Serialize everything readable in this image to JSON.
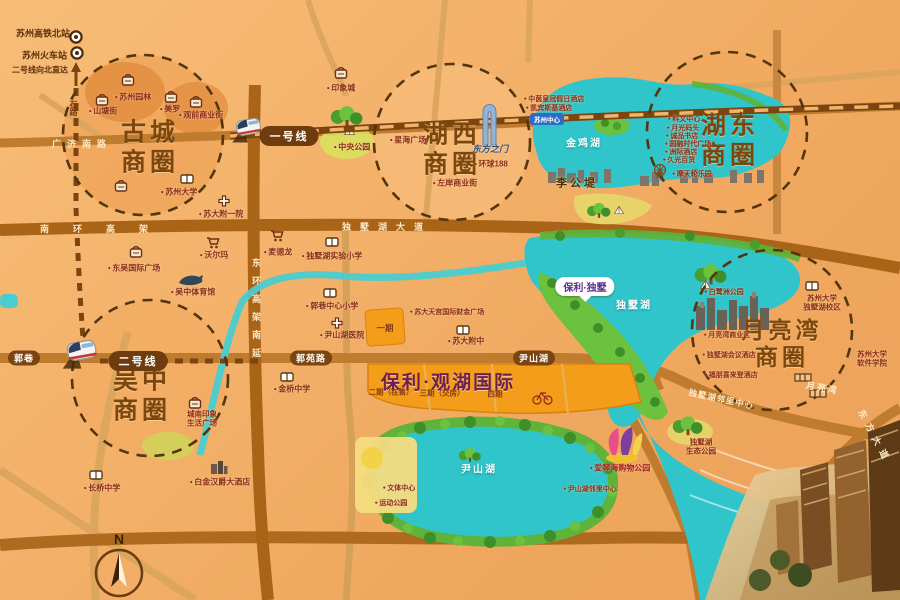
{
  "project": {
    "name": "保利·观湖国际",
    "pin": "保利·独墅",
    "phase1": "一期",
    "phase2": "二期（在售）",
    "phase3": "三期（交房）",
    "phase4": "四期"
  },
  "stations": {
    "north": "苏州高铁北站",
    "main": "苏州火车站",
    "note": "二号线向北直达"
  },
  "metro": {
    "line1": "一号线",
    "line2": "二号线",
    "shilu": "石路"
  },
  "circles": {
    "gucheng": {
      "l1": "古城",
      "l2": "商圈"
    },
    "huxi": {
      "l1": "湖西",
      "l2": "商圈"
    },
    "hudong": {
      "l1": "湖东",
      "l2": "商圈"
    },
    "yueliangwan": {
      "l1": "月亮湾",
      "l2": "商圈"
    },
    "wuzhong": {
      "l1": "吴中",
      "l2": "商圈"
    }
  },
  "lakes": {
    "jinji": "金鸡湖",
    "dushu": "独墅湖",
    "yinshan": "尹山湖",
    "ligongdi": "李公堤"
  },
  "roads": {
    "guangjinanlu": "广济南路",
    "nanhuangaojia": "南环高架",
    "dushuhudadao": "独墅湖大道",
    "donghuannanyan": "东环高架南延",
    "guoxiang": "郭巷",
    "guoyuanlu": "郭苑路",
    "yinshanhu": "尹山湖",
    "yueliangwan": "月亮湾",
    "linlizhongxin": "独墅湖邻里中心",
    "dongfangdadao": "东方大道"
  },
  "compass": "N",
  "pois": [
    {
      "label": "苏州园林"
    },
    {
      "label": "山塘街"
    },
    {
      "label": "美罗"
    },
    {
      "label": "观前商业街"
    },
    {
      "label": "苏州大学"
    },
    {
      "label": "苏大附一院"
    },
    {
      "label": "东吴国际广场"
    },
    {
      "label": "沃尔玛"
    },
    {
      "label": "麦德龙"
    },
    {
      "label": "吴中体育馆"
    },
    {
      "label": "印象城"
    },
    {
      "label": "中央公园"
    },
    {
      "label": "星海广场"
    },
    {
      "label": "东方之门"
    },
    {
      "label": "环球188"
    },
    {
      "label": "左岸商业街"
    },
    {
      "label": "中茵皇冠假日酒店"
    },
    {
      "label": "凯宾斯基酒店"
    },
    {
      "label": "苏州中心"
    },
    {
      "label": "科文中心"
    },
    {
      "label": "月光码头"
    },
    {
      "label": "诚品书店"
    },
    {
      "label": "圆融时代广场"
    },
    {
      "label": "洲际酒店"
    },
    {
      "label": "久光百货"
    },
    {
      "label": "摩天轮乐园"
    },
    {
      "l1": "苏州大学",
      "l2": "独墅湖校区"
    },
    {
      "label": "白鹭洲公园"
    },
    {
      "label": "月亮湾商业区"
    },
    {
      "label": "独墅湖会议酒店"
    },
    {
      "label": "福朋喜来登酒店"
    },
    {
      "l1": "苏州大学",
      "l2": "软件学院"
    },
    {
      "label": "独墅湖实验小学"
    },
    {
      "label": "郭巷中心小学"
    },
    {
      "label": "尹山湖医院"
    },
    {
      "label": "苏大附中"
    },
    {
      "label": "苏大天宫国际财金广场"
    },
    {
      "l1": "城南印象",
      "l2": "生活广场"
    },
    {
      "label": "白金汉爵大酒店"
    },
    {
      "label": "长桥中学"
    },
    {
      "label": "金桥中学"
    },
    {
      "label": "文体中心"
    },
    {
      "label": "运动公园"
    },
    {
      "label": "爱琴海购物公园"
    },
    {
      "label": "尹山湖邻里中心"
    },
    {
      "l1": "独墅湖",
      "l2": "生态公园"
    }
  ]
}
